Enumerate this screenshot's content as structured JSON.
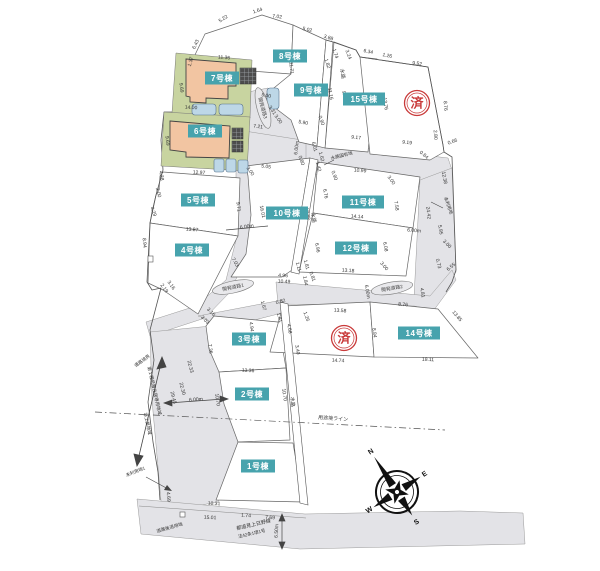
{
  "colors": {
    "lot_label_bg": "#47a3ad",
    "lot_label_text": "#ffffff",
    "stamp_red": "#c93a3a",
    "road_gray": "#e3e3e7",
    "line_gray": "#666666",
    "house_fill": "#f2c5a2",
    "yard_green": "#c8d4a0",
    "car_blue": "#bdd7e7"
  },
  "lot_labels": [
    {
      "t": "1号棟",
      "x": 258,
      "y": 466
    },
    {
      "t": "2号棟",
      "x": 252,
      "y": 394
    },
    {
      "t": "3号棟",
      "x": 249,
      "y": 339
    },
    {
      "t": "4号棟",
      "x": 192,
      "y": 250
    },
    {
      "t": "5号棟",
      "x": 198,
      "y": 200
    },
    {
      "t": "6号棟",
      "x": 205,
      "y": 131
    },
    {
      "t": "7号棟",
      "x": 222,
      "y": 78
    },
    {
      "t": "8号棟",
      "x": 290,
      "y": 56
    },
    {
      "t": "9号棟",
      "x": 311,
      "y": 90
    },
    {
      "t": "10号棟",
      "x": 287,
      "y": 213
    },
    {
      "t": "11号棟",
      "x": 363,
      "y": 202
    },
    {
      "t": "12号棟",
      "x": 356,
      "y": 248
    },
    {
      "t": "14号棟",
      "x": 419,
      "y": 333
    },
    {
      "t": "15号棟",
      "x": 364,
      "y": 99
    }
  ],
  "stamps": [
    {
      "t": "済",
      "x": 417,
      "y": 103
    },
    {
      "t": "済",
      "x": 344,
      "y": 338
    }
  ],
  "road_labels": [
    {
      "t": "開発道路1",
      "x": 233,
      "y": 287,
      "r": -12
    },
    {
      "t": "開発道路2",
      "x": 392,
      "y": 288,
      "r": -10
    },
    {
      "t": "開発道路3",
      "x": 263,
      "y": 108,
      "r": 75
    }
  ],
  "area_labels": [
    {
      "t": "水路",
      "x": 341,
      "y": 74,
      "r": 80,
      "s": 5
    },
    {
      "t": "水路",
      "x": 312,
      "y": 218,
      "r": 80,
      "s": 5
    },
    {
      "t": "水路",
      "x": 291,
      "y": 402,
      "r": 85,
      "s": 5
    },
    {
      "t": "水路国有地",
      "x": 342,
      "y": 157,
      "r": -14,
      "s": 4.5
    },
    {
      "t": "未利用地",
      "x": 447,
      "y": 206,
      "r": 70,
      "s": 4.5
    },
    {
      "t": "未利用地1",
      "x": 136,
      "y": 473,
      "r": -22,
      "s": 4.5
    },
    {
      "t": "道路境界",
      "x": 143,
      "y": 362,
      "r": -35,
      "s": 4.5
    },
    {
      "t": "第１種低層住居専用地域",
      "x": 153,
      "y": 391,
      "r": 77,
      "s": 4.5
    },
    {
      "t": "準工業地域",
      "x": 146,
      "y": 424,
      "r": 77,
      "s": 4.5
    },
    {
      "t": "用途境ライン",
      "x": 333,
      "y": 420,
      "r": 4,
      "s": 5
    },
    {
      "t": "道路後退用地",
      "x": 170,
      "y": 529,
      "r": -16,
      "s": 4.5
    },
    {
      "t": "都道見上日野線",
      "x": 254,
      "y": 526,
      "r": -13,
      "s": 5
    },
    {
      "t": "法42条1項1号",
      "x": 252,
      "y": 535,
      "r": -13,
      "s": 4.5
    }
  ],
  "dimensions": [
    {
      "t": "5.22",
      "x": 224,
      "y": 20,
      "r": -32
    },
    {
      "t": "1.64",
      "x": 258,
      "y": 12,
      "r": -18
    },
    {
      "t": "7.02",
      "x": 277,
      "y": 18,
      "r": 8
    },
    {
      "t": "5.02",
      "x": 307,
      "y": 31,
      "r": 13
    },
    {
      "t": "3.88",
      "x": 328,
      "y": 39,
      "r": 18
    },
    {
      "t": "6.34",
      "x": 368,
      "y": 53,
      "r": 12
    },
    {
      "t": "1.26",
      "x": 387,
      "y": 57,
      "r": 12
    },
    {
      "t": "9.52",
      "x": 417,
      "y": 65,
      "r": 8
    },
    {
      "t": "6.43",
      "x": 197,
      "y": 45,
      "r": -65
    },
    {
      "t": "1.37",
      "x": 192,
      "y": 62,
      "r": -75
    },
    {
      "t": "11.36",
      "x": 224,
      "y": 59,
      "r": 4
    },
    {
      "t": "11.71",
      "x": 290,
      "y": 68,
      "r": 85
    },
    {
      "t": "9.69",
      "x": 180,
      "y": 88,
      "r": 82
    },
    {
      "t": "14.00",
      "x": 191,
      "y": 109,
      "r": 3
    },
    {
      "t": "9.69",
      "x": 166,
      "y": 141,
      "r": 83
    },
    {
      "t": "12.97",
      "x": 199,
      "y": 174,
      "r": 3
    },
    {
      "t": "3.24",
      "x": 347,
      "y": 55,
      "r": 70
    },
    {
      "t": "1.74",
      "x": 334,
      "y": 54,
      "r": 72
    },
    {
      "t": "1.82",
      "x": 326,
      "y": 64,
      "r": 72
    },
    {
      "t": "9.36",
      "x": 343,
      "y": 96,
      "r": 80
    },
    {
      "t": "11.16",
      "x": 329,
      "y": 94,
      "r": 80
    },
    {
      "t": "13.76",
      "x": 384,
      "y": 104,
      "r": 82
    },
    {
      "t": "8.76",
      "x": 444,
      "y": 106,
      "r": 85
    },
    {
      "t": "2.80",
      "x": 434,
      "y": 135,
      "r": 85
    },
    {
      "t": "0.66",
      "x": 453,
      "y": 143,
      "r": -20
    },
    {
      "t": "0.84",
      "x": 423,
      "y": 156,
      "r": 40
    },
    {
      "t": "5.00",
      "x": 266,
      "y": 97,
      "r": 10
    },
    {
      "t": "3.31",
      "x": 271,
      "y": 111,
      "r": 55
    },
    {
      "t": "3.00",
      "x": 277,
      "y": 120,
      "r": 55
    },
    {
      "t": "7.21",
      "x": 258,
      "y": 128,
      "r": 8
    },
    {
      "t": "5.90",
      "x": 303,
      "y": 124,
      "r": 10
    },
    {
      "t": "0.90",
      "x": 320,
      "y": 121,
      "r": 70
    },
    {
      "t": "9.17",
      "x": 356,
      "y": 139,
      "r": 6
    },
    {
      "t": "9.19",
      "x": 407,
      "y": 144,
      "r": 6
    },
    {
      "t": "6.00m",
      "x": 298,
      "y": 148,
      "r": -83
    },
    {
      "t": "6.01",
      "x": 313,
      "y": 147,
      "r": 75
    },
    {
      "t": "1.62",
      "x": 320,
      "y": 157,
      "r": 75
    },
    {
      "t": "1.42",
      "x": 317,
      "y": 167,
      "r": 75
    },
    {
      "t": "0.80",
      "x": 300,
      "y": 161,
      "r": 70
    },
    {
      "t": "0.90",
      "x": 333,
      "y": 176,
      "r": 70
    },
    {
      "t": "5.05",
      "x": 266,
      "y": 168,
      "r": 8
    },
    {
      "t": "3.00",
      "x": 249,
      "y": 172,
      "r": 55
    },
    {
      "t": "10.99",
      "x": 360,
      "y": 172,
      "r": 5
    },
    {
      "t": "3.00",
      "x": 390,
      "y": 181,
      "r": 55
    },
    {
      "t": "4.38",
      "x": 160,
      "y": 176,
      "r": 80
    },
    {
      "t": "2.00",
      "x": 157,
      "y": 193,
      "r": 75
    },
    {
      "t": "4.29",
      "x": 152,
      "y": 212,
      "r": 70
    },
    {
      "t": "9.71",
      "x": 237,
      "y": 207,
      "r": 83
    },
    {
      "t": "16.01",
      "x": 261,
      "y": 212,
      "r": 78
    },
    {
      "t": "6.00m",
      "x": 247,
      "y": 228,
      "r": -8
    },
    {
      "t": "13.87",
      "x": 192,
      "y": 231,
      "r": 4
    },
    {
      "t": "8.94",
      "x": 143,
      "y": 243,
      "r": 85
    },
    {
      "t": "17.72",
      "x": 306,
      "y": 214,
      "r": 80
    },
    {
      "t": "6.76",
      "x": 324,
      "y": 194,
      "r": 80
    },
    {
      "t": "7.58",
      "x": 395,
      "y": 206,
      "r": 82
    },
    {
      "t": "14.14",
      "x": 357,
      "y": 218,
      "r": 5
    },
    {
      "t": "24.42",
      "x": 427,
      "y": 213,
      "r": 83
    },
    {
      "t": "12.38",
      "x": 443,
      "y": 178,
      "r": 80
    },
    {
      "t": "5.95",
      "x": 439,
      "y": 230,
      "r": 80
    },
    {
      "t": "3.00",
      "x": 446,
      "y": 245,
      "r": 45
    },
    {
      "t": "0.73",
      "x": 437,
      "y": 264,
      "r": 75
    },
    {
      "t": "6.55",
      "x": 452,
      "y": 268,
      "r": -40
    },
    {
      "t": "6.00m",
      "x": 414,
      "y": 232,
      "r": 4
    },
    {
      "t": "6.08",
      "x": 384,
      "y": 247,
      "r": 80
    },
    {
      "t": "3.00",
      "x": 383,
      "y": 267,
      "r": 50
    },
    {
      "t": "13.18",
      "x": 348,
      "y": 272,
      "r": 4
    },
    {
      "t": "6.96",
      "x": 316,
      "y": 248,
      "r": 80
    },
    {
      "t": "7.03",
      "x": 234,
      "y": 263,
      "r": 60
    },
    {
      "t": "1.11",
      "x": 297,
      "y": 267,
      "r": 75
    },
    {
      "t": "1.81",
      "x": 305,
      "y": 265,
      "r": 75
    },
    {
      "t": "4.96",
      "x": 283,
      "y": 277,
      "r": 3
    },
    {
      "t": "10.49",
      "x": 284,
      "y": 283,
      "r": 3
    },
    {
      "t": "1.84",
      "x": 304,
      "y": 281,
      "r": 80
    },
    {
      "t": "0.81",
      "x": 311,
      "y": 277,
      "r": 70
    },
    {
      "t": "2.19",
      "x": 163,
      "y": 289,
      "r": 55
    },
    {
      "t": "3.16",
      "x": 170,
      "y": 286,
      "r": 55
    },
    {
      "t": "0.82",
      "x": 281,
      "y": 303,
      "r": -15
    },
    {
      "t": "1.67",
      "x": 262,
      "y": 306,
      "r": 75
    },
    {
      "t": "1.81",
      "x": 278,
      "y": 318,
      "r": 75
    },
    {
      "t": "1.26",
      "x": 305,
      "y": 317,
      "r": 70
    },
    {
      "t": "4.94",
      "x": 250,
      "y": 327,
      "r": 83
    },
    {
      "t": "4.68",
      "x": 288,
      "y": 329,
      "r": 80
    },
    {
      "t": "3.40",
      "x": 296,
      "y": 350,
      "r": 80
    },
    {
      "t": "3.16",
      "x": 210,
      "y": 313,
      "r": 45
    },
    {
      "t": "3.03",
      "x": 204,
      "y": 321,
      "r": 45
    },
    {
      "t": "7.36",
      "x": 209,
      "y": 349,
      "r": 83
    },
    {
      "t": "13.58",
      "x": 340,
      "y": 312,
      "r": 4
    },
    {
      "t": "8.84",
      "x": 373,
      "y": 333,
      "r": 83
    },
    {
      "t": "14.74",
      "x": 338,
      "y": 362,
      "r": 3
    },
    {
      "t": "13.36",
      "x": 248,
      "y": 372,
      "r": 3
    },
    {
      "t": "6.00m",
      "x": 366,
      "y": 292,
      "r": 80
    },
    {
      "t": "4.81",
      "x": 421,
      "y": 293,
      "r": 80
    },
    {
      "t": "8.76",
      "x": 403,
      "y": 306,
      "r": 4
    },
    {
      "t": "13.85",
      "x": 456,
      "y": 317,
      "r": 50
    },
    {
      "t": "18.11",
      "x": 428,
      "y": 361,
      "r": 2
    },
    {
      "t": "22.33",
      "x": 189,
      "y": 367,
      "r": 76
    },
    {
      "t": "22.30",
      "x": 181,
      "y": 389,
      "r": 76
    },
    {
      "t": "29.45",
      "x": 172,
      "y": 398,
      "r": 76
    },
    {
      "t": "6.00m",
      "x": 196,
      "y": 401,
      "r": -4
    },
    {
      "t": "10.70",
      "x": 216,
      "y": 400,
      "r": 82
    },
    {
      "t": "10.70",
      "x": 283,
      "y": 395,
      "r": 82
    },
    {
      "t": "4.69",
      "x": 167,
      "y": 497,
      "r": 85
    },
    {
      "t": "10.31",
      "x": 214,
      "y": 505,
      "r": 3
    },
    {
      "t": "15.01",
      "x": 210,
      "y": 519,
      "r": 3
    },
    {
      "t": "1.74",
      "x": 246,
      "y": 517,
      "r": 3
    },
    {
      "t": "7.69",
      "x": 270,
      "y": 519,
      "r": 3
    },
    {
      "t": "6.50m",
      "x": 278,
      "y": 531,
      "r": -87
    }
  ],
  "compass": {
    "n": "N",
    "e": "E",
    "s": "S",
    "w": "W"
  }
}
